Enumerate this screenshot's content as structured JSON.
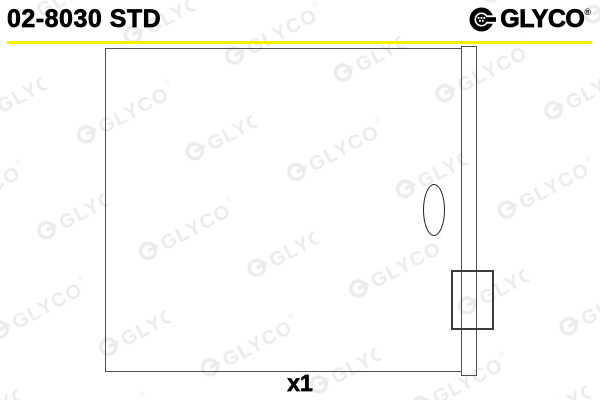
{
  "header": {
    "part_number": "02-8030 STD"
  },
  "brand": {
    "name": "GLYCO",
    "registered_mark": "®"
  },
  "watermark": {
    "text": "GLYCO",
    "registered_mark": "®"
  },
  "drawing": {
    "quantity_label": "x1"
  },
  "colors": {
    "accent_yellow": "#f7ee00",
    "outline_gray": "#4f4f4f",
    "watermark_gray": "#ececec",
    "text_black": "#000000"
  }
}
